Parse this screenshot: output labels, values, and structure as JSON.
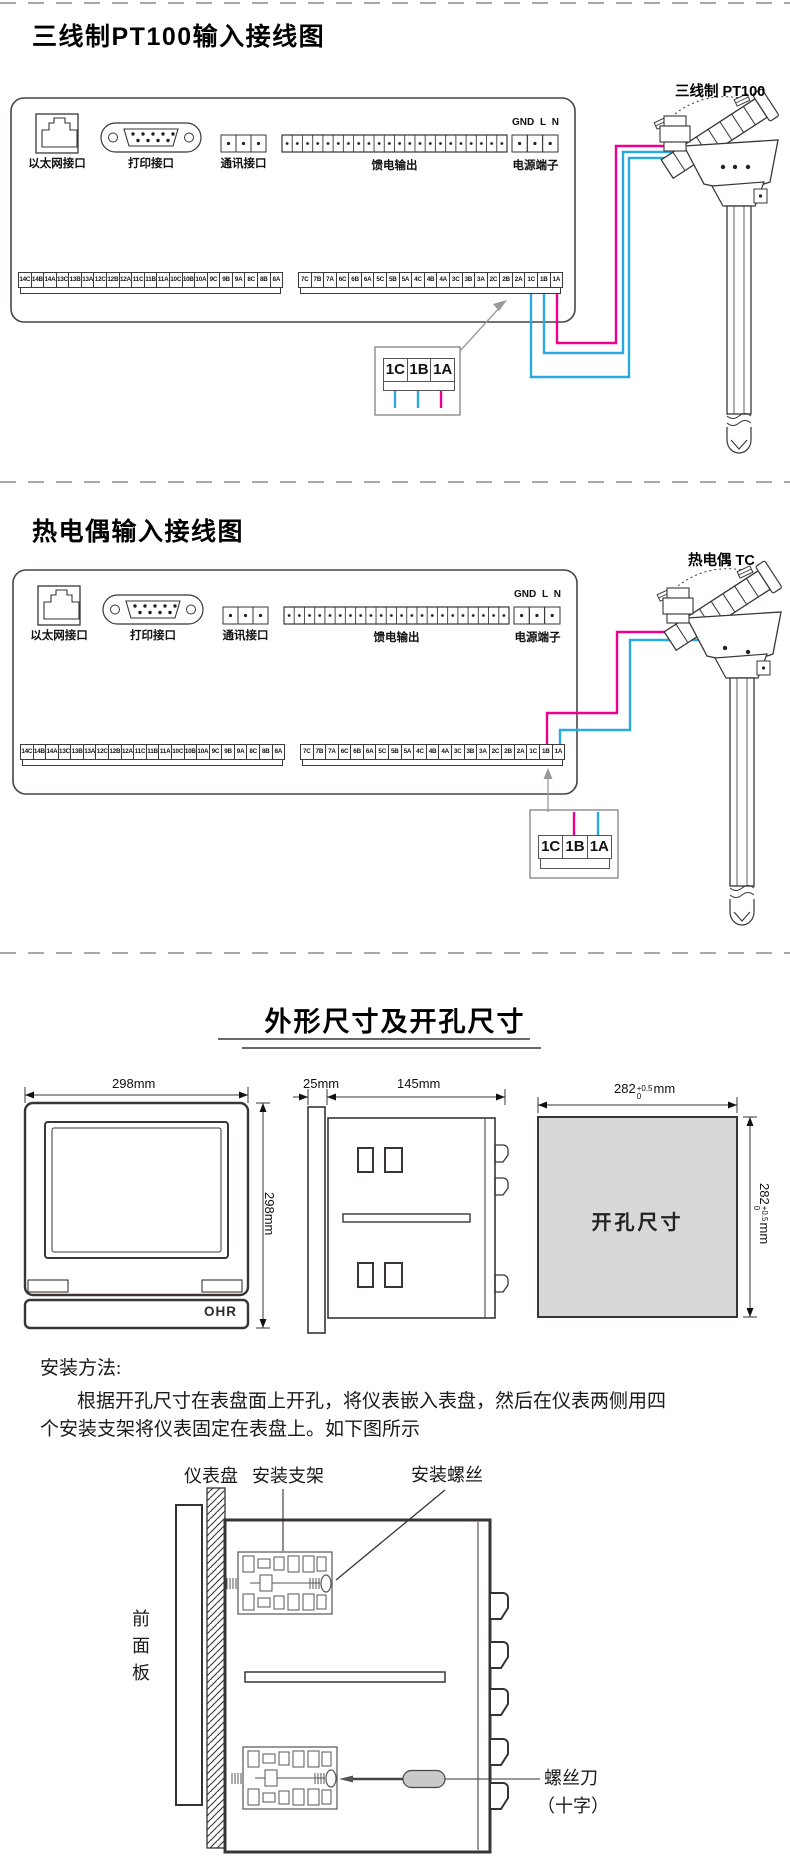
{
  "colors": {
    "wire_blue": "#29abe2",
    "wire_magenta": "#ec008c",
    "line_dark": "#3a3532",
    "cutout_fill": "#d8d8d8",
    "separator_gray": "#a8a8a8"
  },
  "pt100": {
    "title": "三线制PT100输入接线图",
    "sensor_label": "三线制 PT100"
  },
  "tc": {
    "title": "热电偶输入接线图",
    "sensor_label": "热电偶 TC"
  },
  "panel": {
    "ethernet_label": "以太网接口",
    "printer_label": "打印接口",
    "comm_label": "通讯接口",
    "feed_label": "馈电输出",
    "power_label": "电源端子",
    "power_pins": [
      "GND",
      "L",
      "N"
    ],
    "terminals_left": [
      "14C",
      "14B",
      "14A",
      "13C",
      "13B",
      "13A",
      "12C",
      "12B",
      "12A",
      "11C",
      "11B",
      "11A",
      "10C",
      "10B",
      "10A",
      "9C",
      "9B",
      "9A",
      "8C",
      "8B",
      "8A"
    ],
    "terminals_right": [
      "7C",
      "7B",
      "7A",
      "6C",
      "6B",
      "6A",
      "5C",
      "5B",
      "5A",
      "4C",
      "4B",
      "4A",
      "3C",
      "3B",
      "3A",
      "2C",
      "2B",
      "2A",
      "1C",
      "1B",
      "1A"
    ],
    "zoom_cells": [
      "1C",
      "1B",
      "1A"
    ]
  },
  "dims": {
    "title": "外形尺寸及开孔尺寸",
    "front_width": "298mm",
    "front_height": "298mm",
    "logo": "OHR",
    "side_bezel": "25mm",
    "side_depth": "145mm",
    "cutout_label": "开孔尺寸",
    "cutout_base": "282",
    "cutout_tol_up": "+0.5",
    "cutout_tol_down": "0",
    "cutout_unit": "mm"
  },
  "install": {
    "heading": "安装方法:",
    "line1": "根据开孔尺寸在表盘面上开孔，将仪表嵌入表盘，然后在仪表两侧用四",
    "line2": "个安装支架将仪表固定在表盘上。如下图所示",
    "label_panel": "仪表盘",
    "label_bracket": "安装支架",
    "label_screw": "安装螺丝",
    "front_panel_chars": [
      "前",
      "面",
      "板"
    ],
    "label_screwdriver": "螺丝刀",
    "label_screwdriver2": "（十字）"
  }
}
